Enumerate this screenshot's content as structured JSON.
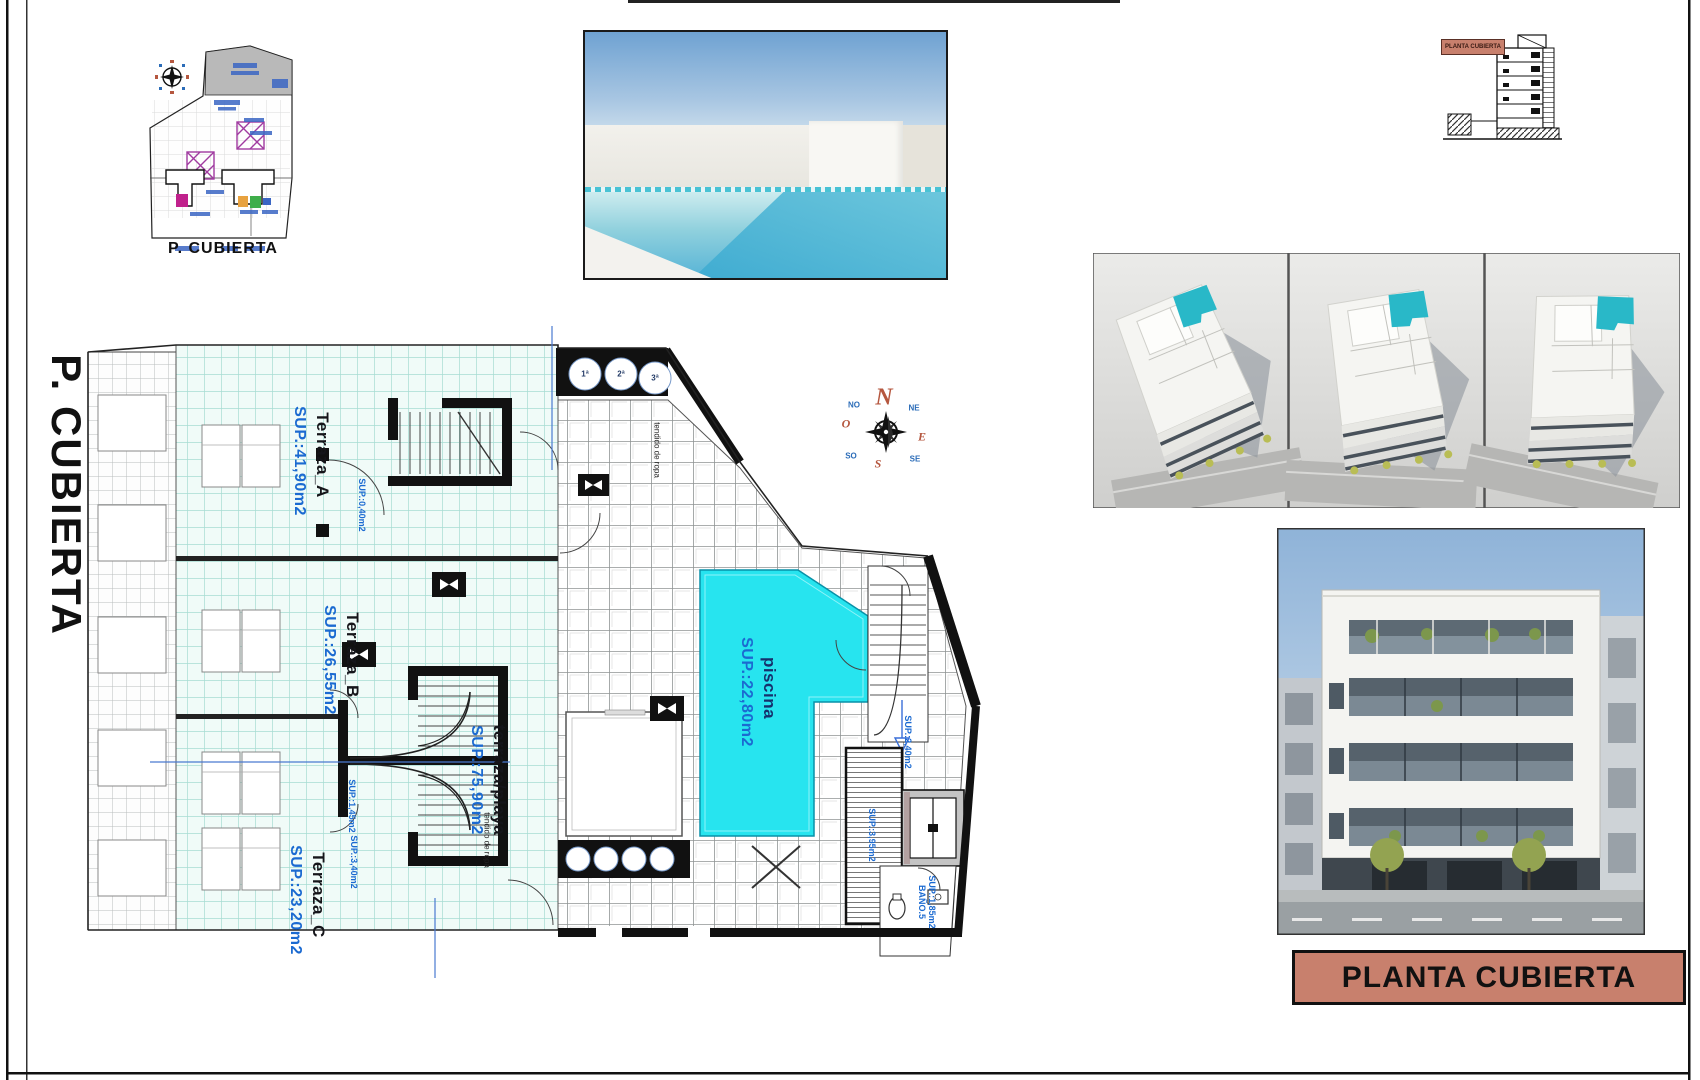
{
  "sheet": {
    "left_title": "P. CUBIERTA",
    "title_block": "PLANTA CUBIERTA"
  },
  "site_plan": {
    "caption": "P. CUBIERTA"
  },
  "section": {
    "label": "PLANTA CUBIERTA"
  },
  "compass": {
    "n": "N",
    "s": "S",
    "e": "E",
    "w": "O",
    "ne": "NE",
    "nw": "NO",
    "se": "SE",
    "sw": "SO"
  },
  "plan": {
    "rooms": [
      {
        "name": "Terraza_A",
        "area": "SUP.:41,90m2"
      },
      {
        "name": "Terraza_B",
        "area": "SUP.:26,55m2"
      },
      {
        "name": "Terraza_C",
        "area": "SUP.:23,20m2"
      },
      {
        "name": "terraza/playa",
        "area": "SUP.:75,90m2"
      },
      {
        "name": "piscina",
        "area": "SUP.:22,80m2"
      }
    ],
    "details": {
      "stair_a_area": "SUP.:0,40m2",
      "stair_b_area": "SUP.:1,45m2",
      "stair_c_area": "SUP.:3,40m2",
      "landing_area": "SUP.:2,40m2",
      "laundry_area": "SUP.:3,95m2",
      "bath_name": "BAÑO.5",
      "bath_area": "SUP.:1,85m2",
      "clothesline_1": "tendido de ropa",
      "clothesline_2": "tendido de ropa",
      "vents": [
        "1ª",
        "2ª",
        "3ª"
      ]
    }
  },
  "colors": {
    "accent": "#c8806d",
    "pool": "#27e4ef",
    "terrace_tile": "#f0fbf8",
    "tile_line": "#a7dcd2",
    "label_blue": "#1b6ad1"
  }
}
